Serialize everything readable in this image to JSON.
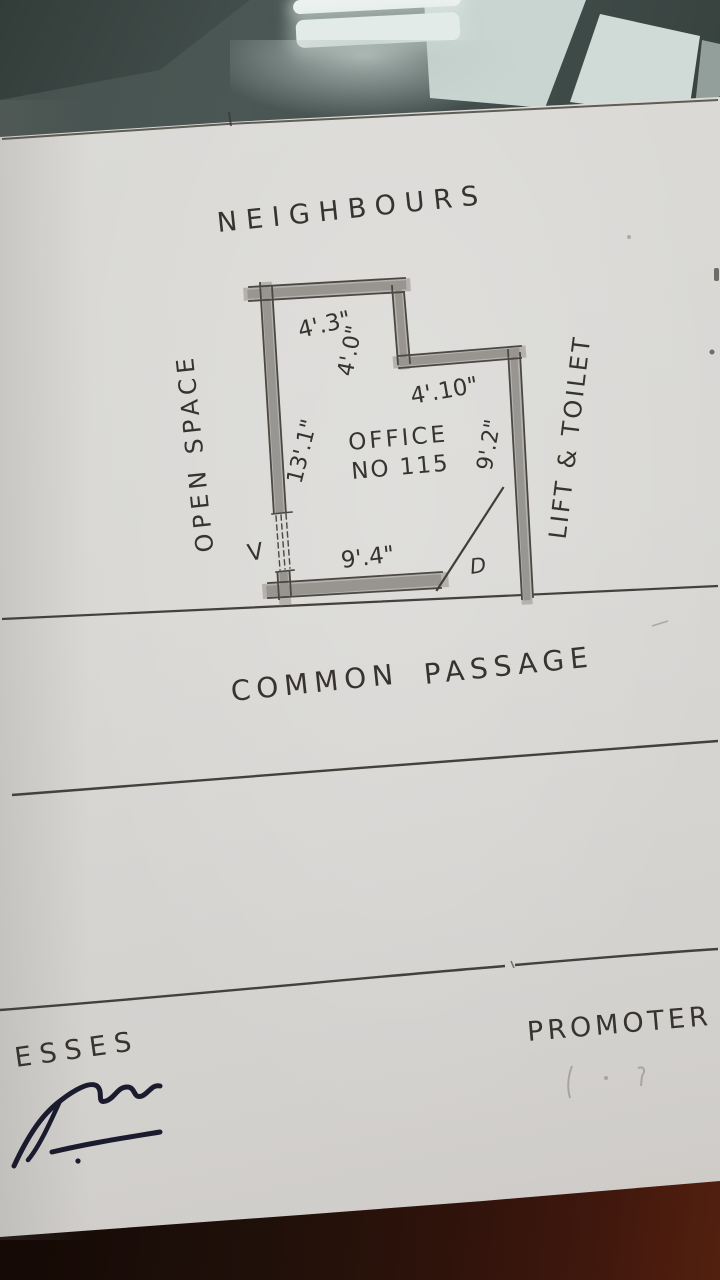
{
  "document": {
    "type_note": "hand-drawn floor plan sketch on paper",
    "top_label": "NEIGHBOURS",
    "left_label": "OPEN  SPACE",
    "right_label": "LIFT & TOILET",
    "room": {
      "label_line1": "OFFICE",
      "label_line2": "NO 115",
      "dim_top": "4'.3\"",
      "dim_step": "4'.0\"",
      "dim_mid": "4'.10\"",
      "dim_left": "13'.1\"",
      "dim_right": "9'.2\"",
      "dim_bottom": "9'.4\"",
      "door_label": "D",
      "window_label": "V"
    },
    "passage_word1": "COMMON",
    "passage_word2": "PASSAGE",
    "promoter_label": "PROMOTER",
    "witness_label": "ESSES"
  },
  "colors": {
    "paper": "#d9d8d5",
    "pencil_line": "#45423e",
    "pencil_text": "#37342f",
    "wall_fill": "#b5b2ae",
    "signature_ink": "#1b1b2e",
    "glass_background": "#46524f",
    "reflection_light": "#eef3f1",
    "table_wood_dark": "#20100a",
    "table_wood_light": "#53200f"
  }
}
